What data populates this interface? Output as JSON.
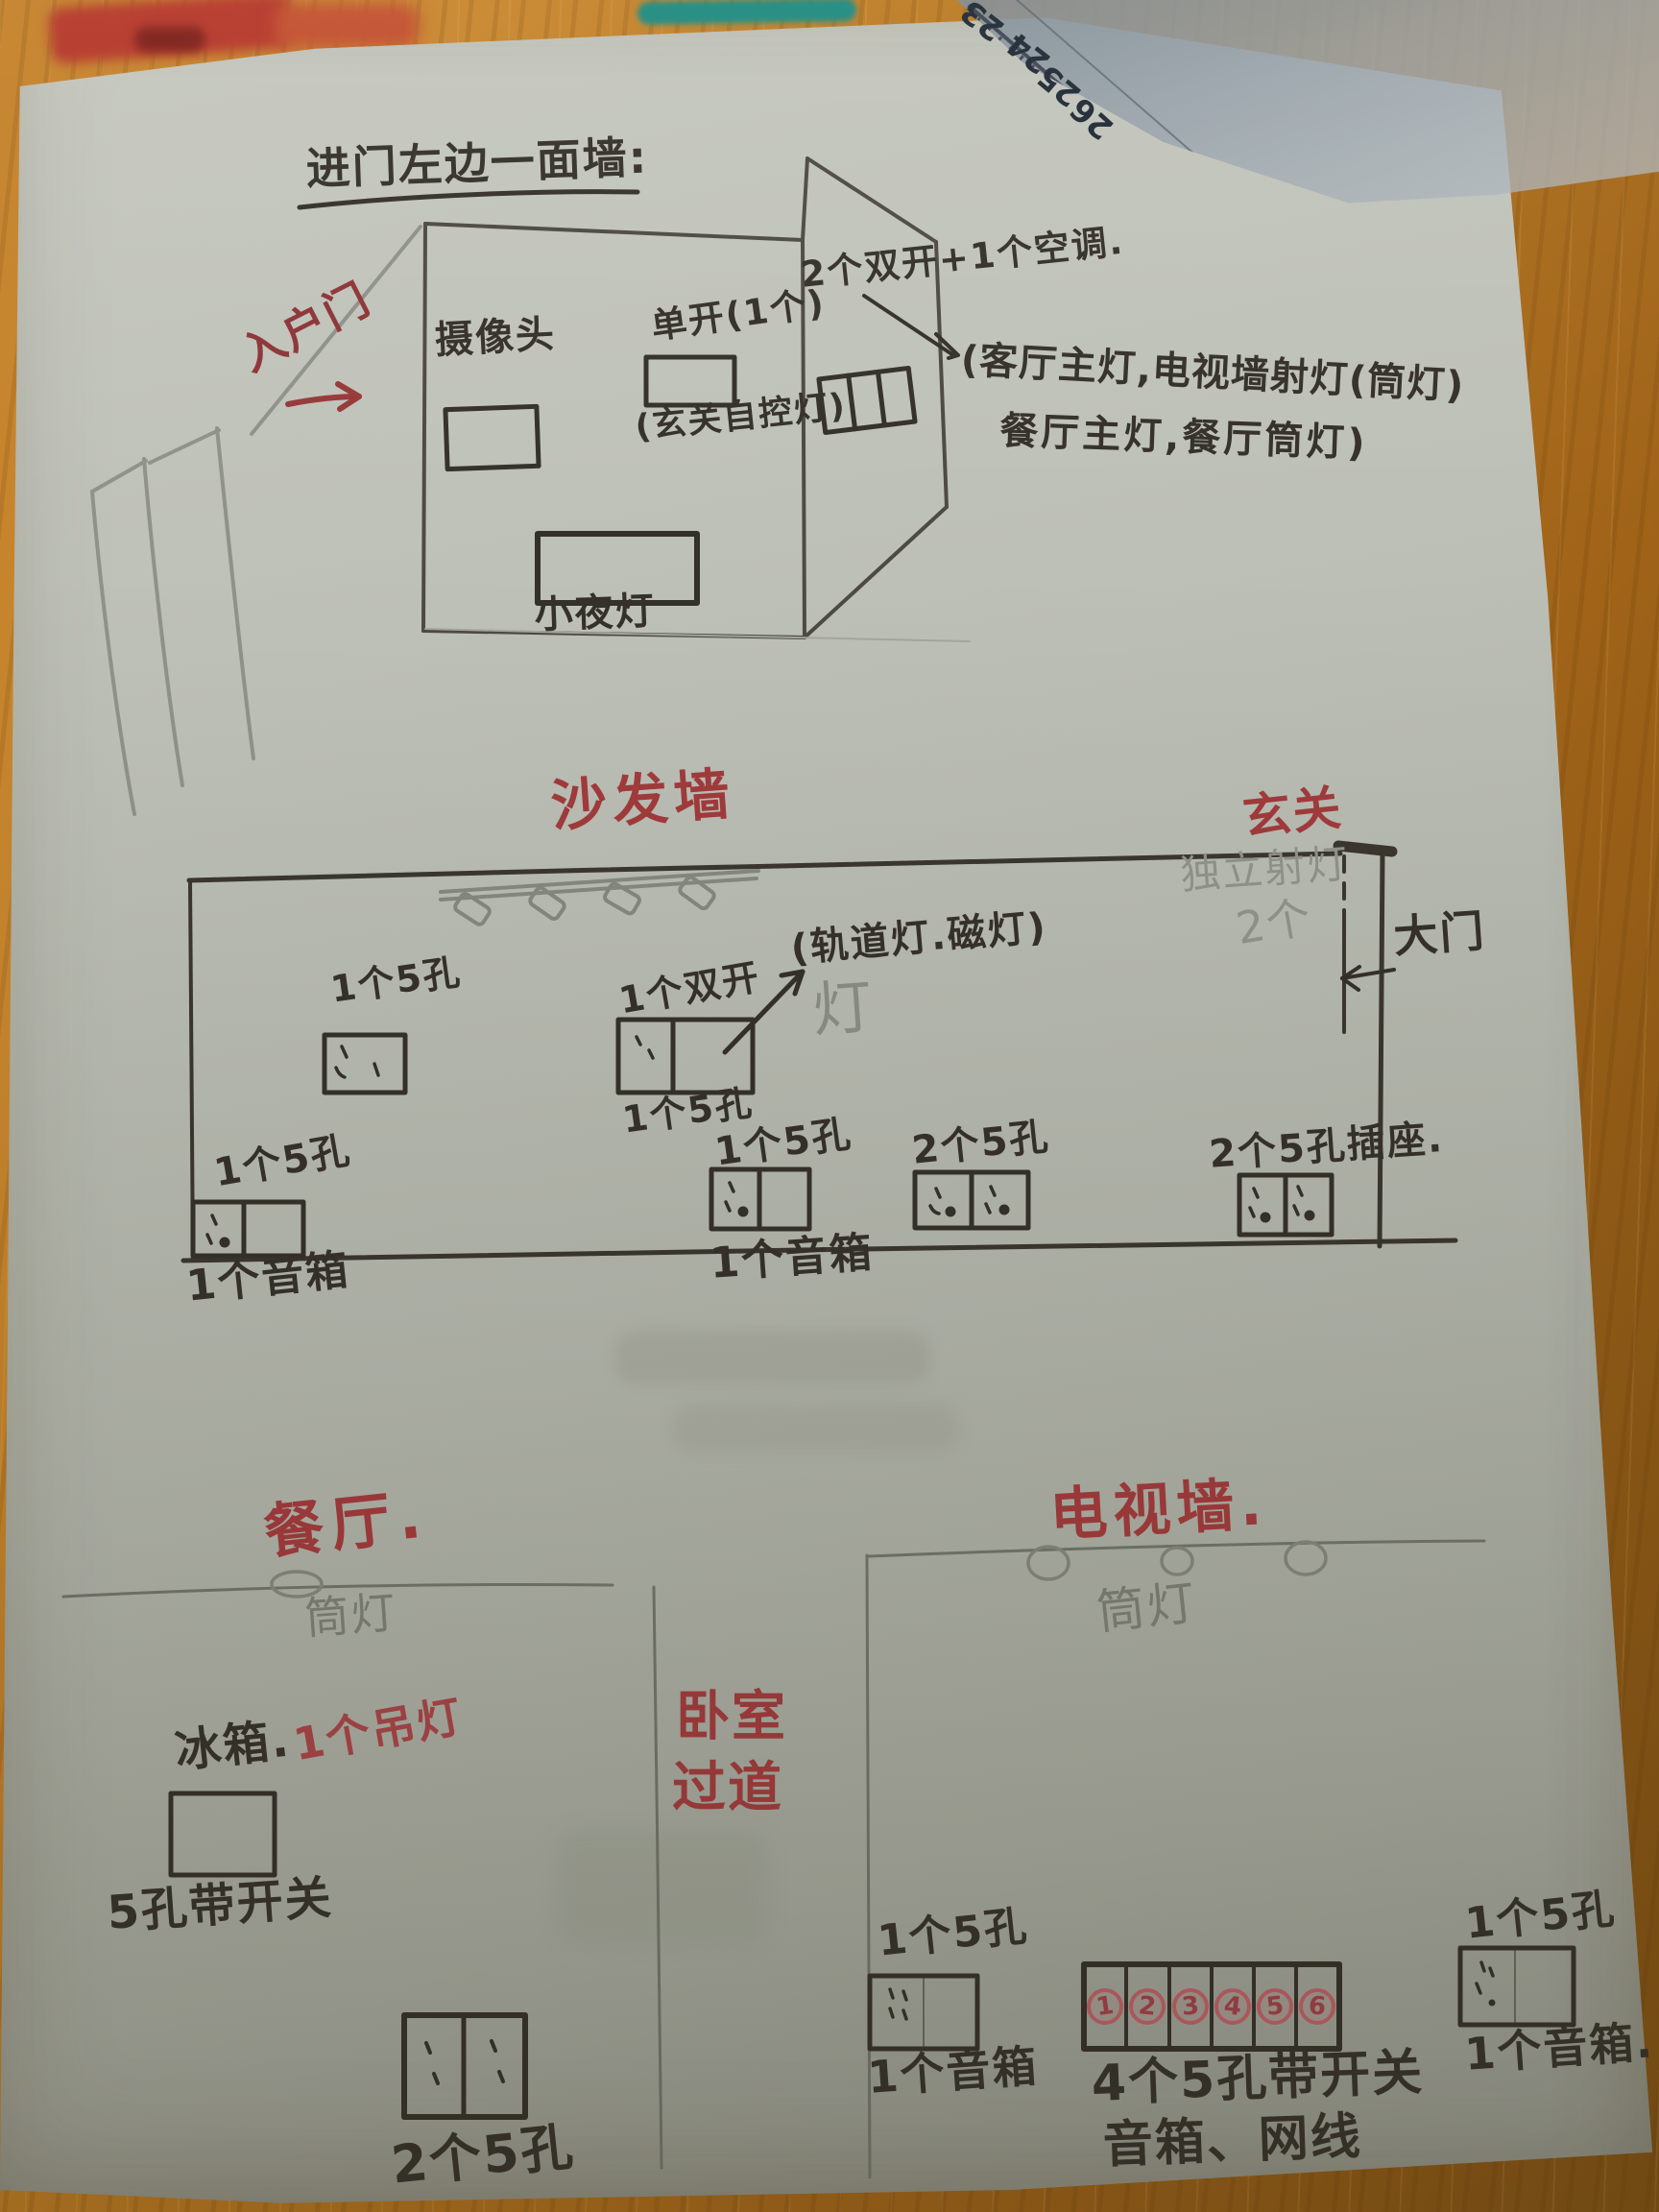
{
  "title": "进门左边一面墙:",
  "top_sketch": {
    "entry_door": "入户门",
    "camera": "摄像头",
    "single_switch": "单开(1个)",
    "single_switch_note": "(玄关自控灯)",
    "switch_group": "2个双开+1个空调.",
    "controls_line1": "(客厅主灯,电视墙射灯(筒灯)",
    "controls_line2": "餐厅主灯,餐厅筒灯)",
    "night_light": "小夜灯"
  },
  "sofa_wall": {
    "wall_title": "沙发墙",
    "foyer_title": "玄关",
    "track_note": "(轨道灯.磁灯)",
    "track_ghost": "灯",
    "double_switch": "1个双开",
    "spot_note1": "独立射灯",
    "spot_note2": "2个",
    "main_door": "大门",
    "socket_mid_wall": "1个5孔",
    "socket_under_switch": "1个5孔",
    "socket_bl": "1个5孔",
    "speaker_bl": "1个音箱",
    "socket_bm": "1个5孔",
    "speaker_bm": "1个音箱",
    "socket_2x": "2个5孔",
    "socket_2x_outlet": "2个5孔插座."
  },
  "floor_plan": {
    "dining_title": "餐厅.",
    "tv_wall_title": "电视墙.",
    "downlight_dining": "筒灯",
    "downlight_tv": "筒灯",
    "corridor_line1": "卧室",
    "corridor_line2": "过道",
    "pendant": "1个吊灯",
    "fridge": "冰箱.",
    "fridge_socket": "5孔带开关",
    "dining_socket": "2个5孔",
    "corridor_socket": "1个5孔",
    "corridor_speaker": "1个音箱",
    "tv_socket_numbers": [
      "1",
      "2",
      "3",
      "4",
      "5",
      "6"
    ],
    "tv_socket_note1": "4个5孔带开关",
    "tv_socket_note2": "音箱、网线",
    "right_socket": "1个5孔",
    "right_speaker": "1个音箱."
  },
  "desk": {
    "ruler_numbers": [
      "23",
      "24",
      "25",
      "26"
    ]
  },
  "colors": {
    "ink": "#35312a",
    "red_ink": "#a13a3c",
    "pencil": "#90938a",
    "paper": "#b7bab1",
    "wood": "#b5771f",
    "ruler": "#98a3ac"
  }
}
